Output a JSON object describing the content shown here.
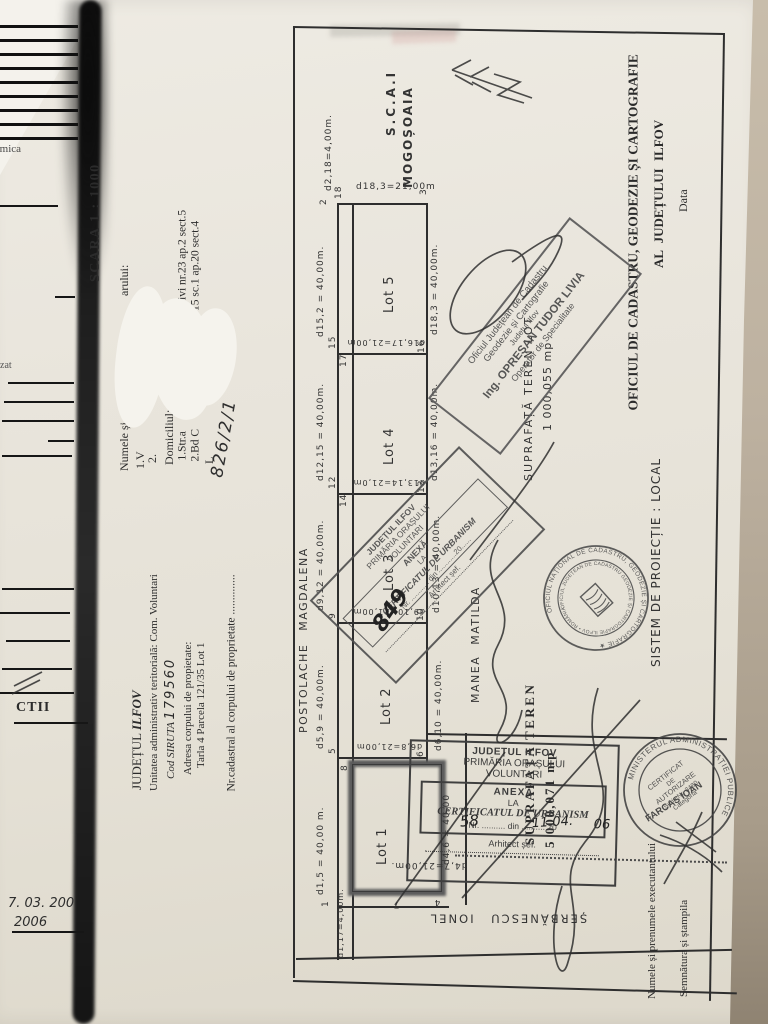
{
  "photo": {
    "paper_color": "#e8e4da",
    "background_color": "#b3a795",
    "ink_color": "#2b2b2b"
  },
  "side_strip": {
    "fragment_top": "rmica",
    "fragment_mid": "zat",
    "label_ctii": "CTII",
    "date_line1": "7. 03. 200",
    "date_line2": "2006"
  },
  "left_column": {
    "scale": "SCARA 1 : 1000",
    "owner_label_start": "Numele și",
    "owner_label_end": "arului:",
    "row1": "1.V",
    "row2": "2.",
    "domicile_label": "Domiciliul:",
    "addr1_start": "1.Str.a",
    "addr1_end": "ovivi nr.23 ap.2 sect.5",
    "addr2_start": "2.Bd C",
    "addr2_end": "r.11 bl.B15 sc.1 ap.20 sect.4",
    "lot_fragment": "L",
    "county_label": "JUDEȚUL ",
    "county_value": "ILFOV",
    "admin_unit": "Unitatea administrativ teritorială: Com. Voluntari",
    "siruta_label": "Cod SIRUTA ",
    "siruta_value": "179560",
    "address_label": "Adresa corpului de propietate:",
    "address_value": "Tarla 4 Parcela 121/35 Lot 1",
    "cadastral_label": "Nr.cadastral al corpului de proprietate ",
    "cadastral_dots": "..............",
    "cadastral_value": "826/2/1"
  },
  "header_right": {
    "office_line1": "OFICIUL DE CADASTRU, GEODEZIE ȘI CARTOGRAFIE",
    "office_line2": "AL JUDEȚULUI ILFOV",
    "date_label": "Data",
    "projection": "SISTEM DE PROIECȚIE : LOCAL",
    "executor_label": "Numele și prenumele executantului",
    "signature_label": "Semnătura și ștampila"
  },
  "plan": {
    "north_line1": "S.C.A.I",
    "north_line2": "MOGOȘOAIA",
    "neighbor_west": "POSTOLACHE MAGDALENA",
    "neighbor_east": "MANEA MATILDA",
    "neighbor_south": "ȘERBĂNESCU IONEL",
    "lot1": "Lot 1",
    "lot2": "Lot 2",
    "lot3": "Lot 3",
    "lot4": "Lot 4",
    "lot5": "Lot 5",
    "surface_lot_label": "SUPRAFAȚĂ TEREN LOT",
    "surface_lot_value": "1 000,055 mp",
    "surface_total_label": "SUPRAFAȚA TEREN",
    "surface_total_value": "5 000,071 mp",
    "dims": {
      "d2_18": "d2,18=4,00m.",
      "d18_3_top": "d18,3=21,00m",
      "d15_2": "d15,2 = 40,00m.",
      "d18_3_right": "d18,3 = 40,00m.",
      "d16_17": "d16,17=21,00m",
      "d12_15": "d12,15 = 40,00m.",
      "d13_16": "d13,16 = 40,00m.",
      "d13_14": "d13,14=21,0m",
      "d9_12": "d9,12 = 40,00m.",
      "d10_13": "d10,13 = 40,00m.",
      "d9_10": "d9,10=21,00m",
      "d5_9": "d5,9 = 40,00m.",
      "d6_10": "d6,10 = 40,00m.",
      "d6_8": "d6,8=21,00m",
      "d1_5": "d1,5 = 40,00 m.",
      "d4_6": "d4,6 = 40,00",
      "d4_7": "d4,7=21,00m.",
      "d1_17": "d1,17=4,00m."
    },
    "points": {
      "p1": "1",
      "p2": "2",
      "p3": "3",
      "p4": "4",
      "p5": "5",
      "p6": "6",
      "p7": "7",
      "p8": "8",
      "p9": "9",
      "p10": "10",
      "p12": "12",
      "p13": "13",
      "p14": "14",
      "p15": "15",
      "p16": "16",
      "p17": "17",
      "p18": "18"
    }
  },
  "stamps": {
    "opresan": {
      "line1": "Oficiul Județean de Cadastru",
      "line2": "Geodezie și Cartografie",
      "line3": "Județul Ilfov",
      "line4": "Ing. OPREȘAN TUDOR LIVIA",
      "line5": "Operator de Specialitate"
    },
    "anexa_mid": {
      "header1": "JUDEȚUL ILFOV",
      "header2": "PRIMĂRIA ORAȘULUI",
      "header3": "VOLUNTARI",
      "title1": "ANEXĂ",
      "title2": "LA",
      "title3": "CERTIFICATUL DE URBANISM",
      "nr_line": "Nr. ............ din ............20......",
      "sign_label": "Arhitect șef.",
      "hand_number": "849"
    },
    "anexa_bottom": {
      "header1": "JUDEȚUL ILFOV",
      "header2": "PRIMĂRIA ORAȘULUI",
      "header3": "VOLUNTARI",
      "title1": "ANEXĂ",
      "title2": "LA",
      "title3": "CERTIFICATUL DE URBANISM",
      "nr_label": "Nr.",
      "dots_a": "..........",
      "din_label": "din",
      "dots_b": "..........",
      "year_prefix": "20",
      "hand_number": "58",
      "hand_date": "11.04.",
      "hand_year": "06",
      "sign_label": "Arhitect șef."
    },
    "round_cadastru": {
      "ring_outer": "OFICIUL NAȚIONAL DE CADASTRU, GEODEZIE ȘI CARTOGRAFIE ★",
      "ring_inner": "OFICIUL JUDEȚEAN DE CADASTRU GEODEZIE ȘI CARTOGRAFIE ILFOV • ROMÂNIA"
    },
    "round_minister": {
      "ring": "MINISTERUL ADMINISTRAȚIEI PUBLICE",
      "cert_line1": "CERTIFICAT",
      "cert_line2": "DE",
      "cert_line3": "AUTORIZARE",
      "cert_line4": "Seria Nr. 3480",
      "cert_line5": "Categoria",
      "name": "FARCAȘ IOAN"
    }
  }
}
